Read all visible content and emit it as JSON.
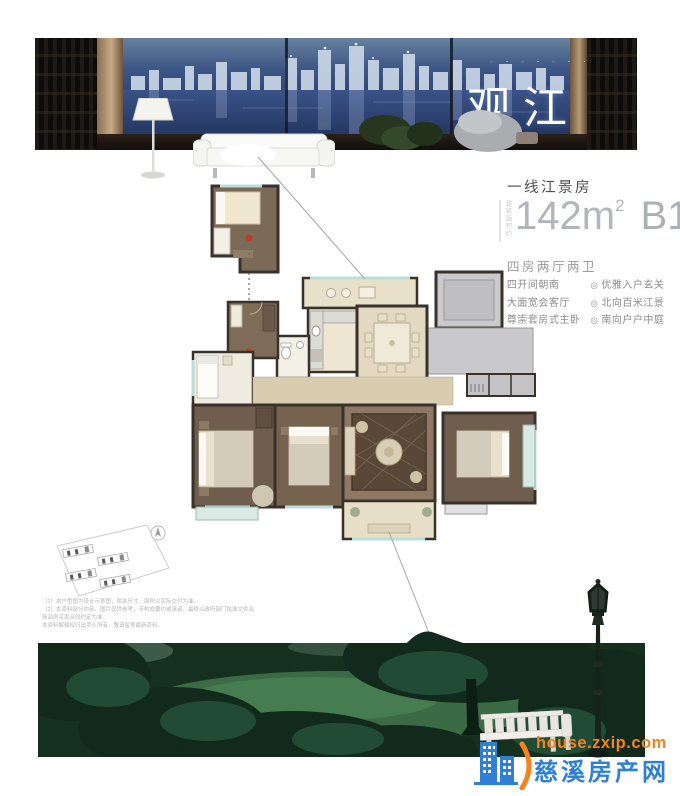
{
  "banner": {
    "title": "观江",
    "title_dots": "· · · · · · ·"
  },
  "headline": {
    "tagline": "一线江景房",
    "area_label_vertical": "建筑面积约",
    "area_number": "142m",
    "area_superscript": "2",
    "plan_code": "B1",
    "layout_summary": "四房两厅两卫"
  },
  "features": {
    "bullet": "◎",
    "items_left": [
      "四开间朝南",
      "大面宽会客厅",
      "尊崇套房式主卧"
    ],
    "items_right": [
      "优雅入户玄关",
      "北向百米江景",
      "南向户户中庭"
    ]
  },
  "siteplan_notes": {
    "line1": "（1）本户型图为设计示意图，相关尺寸、面积以实际交付为准。",
    "line2": "（2）本资料部分内容、图片仅供参考，不构成要约或承诺，最终以政府部门批准文件及商品房买卖合同约定为准。",
    "line3": "本资料解释权归出卖人所有，敬请留意最新资料。"
  },
  "watermark": {
    "site_url": "house.zxip.com",
    "site_name": "慈溪房产网"
  },
  "colors": {
    "marker_red": "#bf3a2b",
    "watermark_orange": "#f5831f",
    "watermark_blue": "#2f7fd4",
    "floor_beige": "#e6dcc6",
    "floor_brown": "#6f5e4d",
    "common_gray": "#c9c9cb"
  }
}
